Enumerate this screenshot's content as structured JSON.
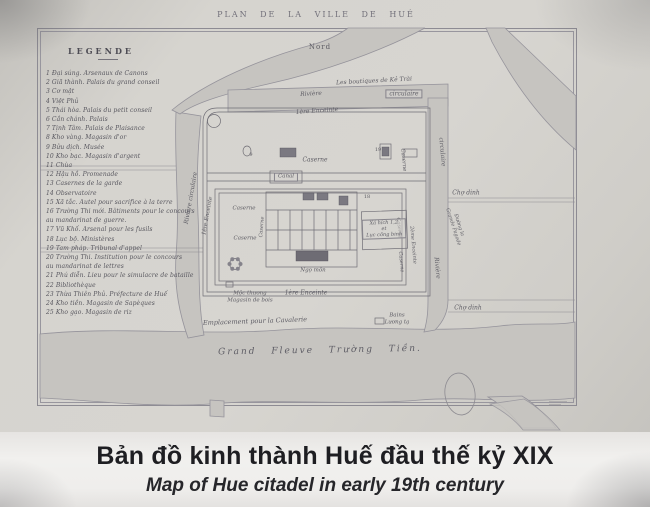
{
  "photo": {
    "colors": {
      "paper": "#d5d3ce",
      "map_ink": "#6f6d75",
      "river_fill": "#c6c4c0",
      "caption_background": "#f0efed",
      "caption_text": "#1f1f23"
    },
    "map_sheet": {
      "title": "PLAN DE LA VILLE DE HUÉ",
      "legend": {
        "title": "LEGENDE",
        "items": [
          "1 Đại súng. Arsenaux de Canons",
          "2 Giã thành. Palais du grand conseil",
          "3 Cơ mật",
          "4 Việt Phủ",
          "5 Thái hòa. Palais du petit conseil",
          "6 Cần chánh. Palais",
          "7 Tịnh Tâm. Palais de Plaisance",
          "8 Kho vàng. Magasin d'or",
          "9 Bửu dịch. Musée",
          "10 Kho bạc. Magasin d'argent",
          "11 Chùa",
          "12 Hậu hồ. Promenade",
          "13 Casernes de la garde",
          "14 Observatoire",
          "15 Xã tắc. Autel pour sacrifice à la terre",
          "16 Trường Thi mới. Bâtiments pour le concours\n     au mandarinat de guerre.",
          "17 Vũ Khố. Arsenal pour les fusils",
          "18 Lục bộ. Ministères",
          "19 Tam pháp. Tribunal d'appel",
          "20 Trường Thi. Institution pour le concours\n     au mandarinat de lettres",
          "21 Phú diễn. Lieu pour le simulacre de bataille",
          "22 Bibliothèque",
          "23 Thừa Thiên Phủ. Préfecture de Huế",
          "24 Kho tiền. Magasin de Sapèques",
          "25 Kho gạo. Magasin de riz"
        ]
      },
      "labels": [
        {
          "n": "north-label",
          "t": "Nord",
          "x": 320,
          "y": 47,
          "r": 0,
          "s": 7,
          "ls": 1,
          "italic": false
        },
        {
          "n": "boutiques-ke-trai-label",
          "t": "Les boutiques de Kẻ Trài",
          "x": 374,
          "y": 81,
          "r": -3,
          "s": 6
        },
        {
          "n": "riviere-label",
          "t": "Rivière",
          "x": 311,
          "y": 94,
          "r": -3,
          "s": 6
        },
        {
          "n": "circulaire-label",
          "t": "circulaire",
          "x": 404,
          "y": 94,
          "r": 0,
          "s": 6,
          "box": true
        },
        {
          "n": "premiere-enceinte-label",
          "t": "1ère Enceinte",
          "x": 317,
          "y": 111,
          "r": -4,
          "s": 6
        },
        {
          "n": "caserne-label",
          "t": "Caserne",
          "x": 315,
          "y": 160,
          "r": 0,
          "s": 6
        },
        {
          "n": "marker-9",
          "t": "9",
          "x": 251,
          "y": 155,
          "r": 0,
          "s": 5,
          "italic": false
        },
        {
          "n": "canal-label",
          "t": "Canal",
          "x": 286,
          "y": 177,
          "r": 0,
          "s": 5.5,
          "box": true
        },
        {
          "n": "caserne-label",
          "t": "Caserne",
          "x": 403,
          "y": 160,
          "r": 85,
          "s": 5.5
        },
        {
          "n": "marker-19",
          "t": "19",
          "x": 378,
          "y": 150,
          "r": 0,
          "s": 5,
          "italic": false
        },
        {
          "n": "riviere-circulaire-label",
          "t": "Rivière circulaire",
          "x": 191,
          "y": 198,
          "r": -80,
          "s": 6
        },
        {
          "n": "premiere-enceinte-label",
          "t": "1ère Enceinte",
          "x": 208,
          "y": 216,
          "r": -80,
          "s": 5.5
        },
        {
          "n": "caserne-label",
          "t": "Caserne",
          "x": 244,
          "y": 209,
          "r": 0,
          "s": 5.5
        },
        {
          "n": "caserne-label",
          "t": "Caserne",
          "x": 245,
          "y": 239,
          "r": 0,
          "s": 5.5
        },
        {
          "n": "caserne-label",
          "t": "Caserne",
          "x": 262,
          "y": 227,
          "r": -85,
          "s": 5
        },
        {
          "n": "marker-18",
          "t": "18",
          "x": 367,
          "y": 197,
          "r": 0,
          "s": 5,
          "italic": false
        },
        {
          "n": "caserne-label",
          "t": "Caserne",
          "x": 399,
          "y": 228,
          "r": 85,
          "s": 5
        },
        {
          "n": "caserne-label",
          "t": "Caserne",
          "x": 401,
          "y": 262,
          "r": 85,
          "s": 5
        },
        {
          "n": "xa-hich-box-label",
          "t": "Xá hích 1,2\net\nLục công binh",
          "x": 384,
          "y": 229,
          "r": -2,
          "s": 5,
          "box": true,
          "multi": true
        },
        {
          "n": "deuxieme-enceinte-label",
          "t": "2ème Enceinte",
          "x": 413,
          "y": 245,
          "r": 85,
          "s": 5
        },
        {
          "n": "circulaire-label",
          "t": "circulaire",
          "x": 442,
          "y": 152,
          "r": 85,
          "s": 6
        },
        {
          "n": "riviere-label",
          "t": "Rivière",
          "x": 437,
          "y": 268,
          "r": 85,
          "s": 6
        },
        {
          "n": "cho-dinh-label",
          "t": "Chợ dinh",
          "x": 466,
          "y": 193,
          "r": 0,
          "s": 6
        },
        {
          "n": "grande-pagode-road-label",
          "t": "Đường la\nGrande Pagode",
          "x": 456,
          "y": 226,
          "r": 72,
          "s": 5,
          "multi": true
        },
        {
          "n": "cho-dinh-label",
          "t": "Chợ dinh",
          "x": 468,
          "y": 308,
          "r": 0,
          "s": 6
        },
        {
          "n": "ngo-mon-label",
          "t": "Ngọ môn",
          "x": 313,
          "y": 271,
          "r": 0,
          "s": 5.5
        },
        {
          "n": "magasin-de-bois-label",
          "t": "Mộc thương\nMagasin de bois",
          "x": 250,
          "y": 297,
          "r": 0,
          "s": 5.5,
          "multi": true
        },
        {
          "n": "premiere-enceinte-label",
          "t": "1ère Enceinte",
          "x": 306,
          "y": 293,
          "r": 0,
          "s": 6
        },
        {
          "n": "bains-luong-ta-label",
          "t": "Bains\nLương tạ",
          "x": 397,
          "y": 319,
          "r": 0,
          "s": 5.5,
          "multi": true
        },
        {
          "n": "cavalerie-label",
          "t": "Emplacement pour la Cavalerie",
          "x": 255,
          "y": 322,
          "r": -2,
          "s": 6.5
        },
        {
          "n": "grand-fleuve-label",
          "t": "Grand Fleuve Trường Tiền.",
          "x": 320,
          "y": 351,
          "r": -1,
          "s": 9,
          "ls": 2,
          "ws": 10
        }
      ]
    },
    "caption": {
      "line_vi": "Bản đồ kinh thành Huế đầu thế kỷ XIX",
      "line_en": "Map of Hue citadel in early 19th century"
    }
  }
}
